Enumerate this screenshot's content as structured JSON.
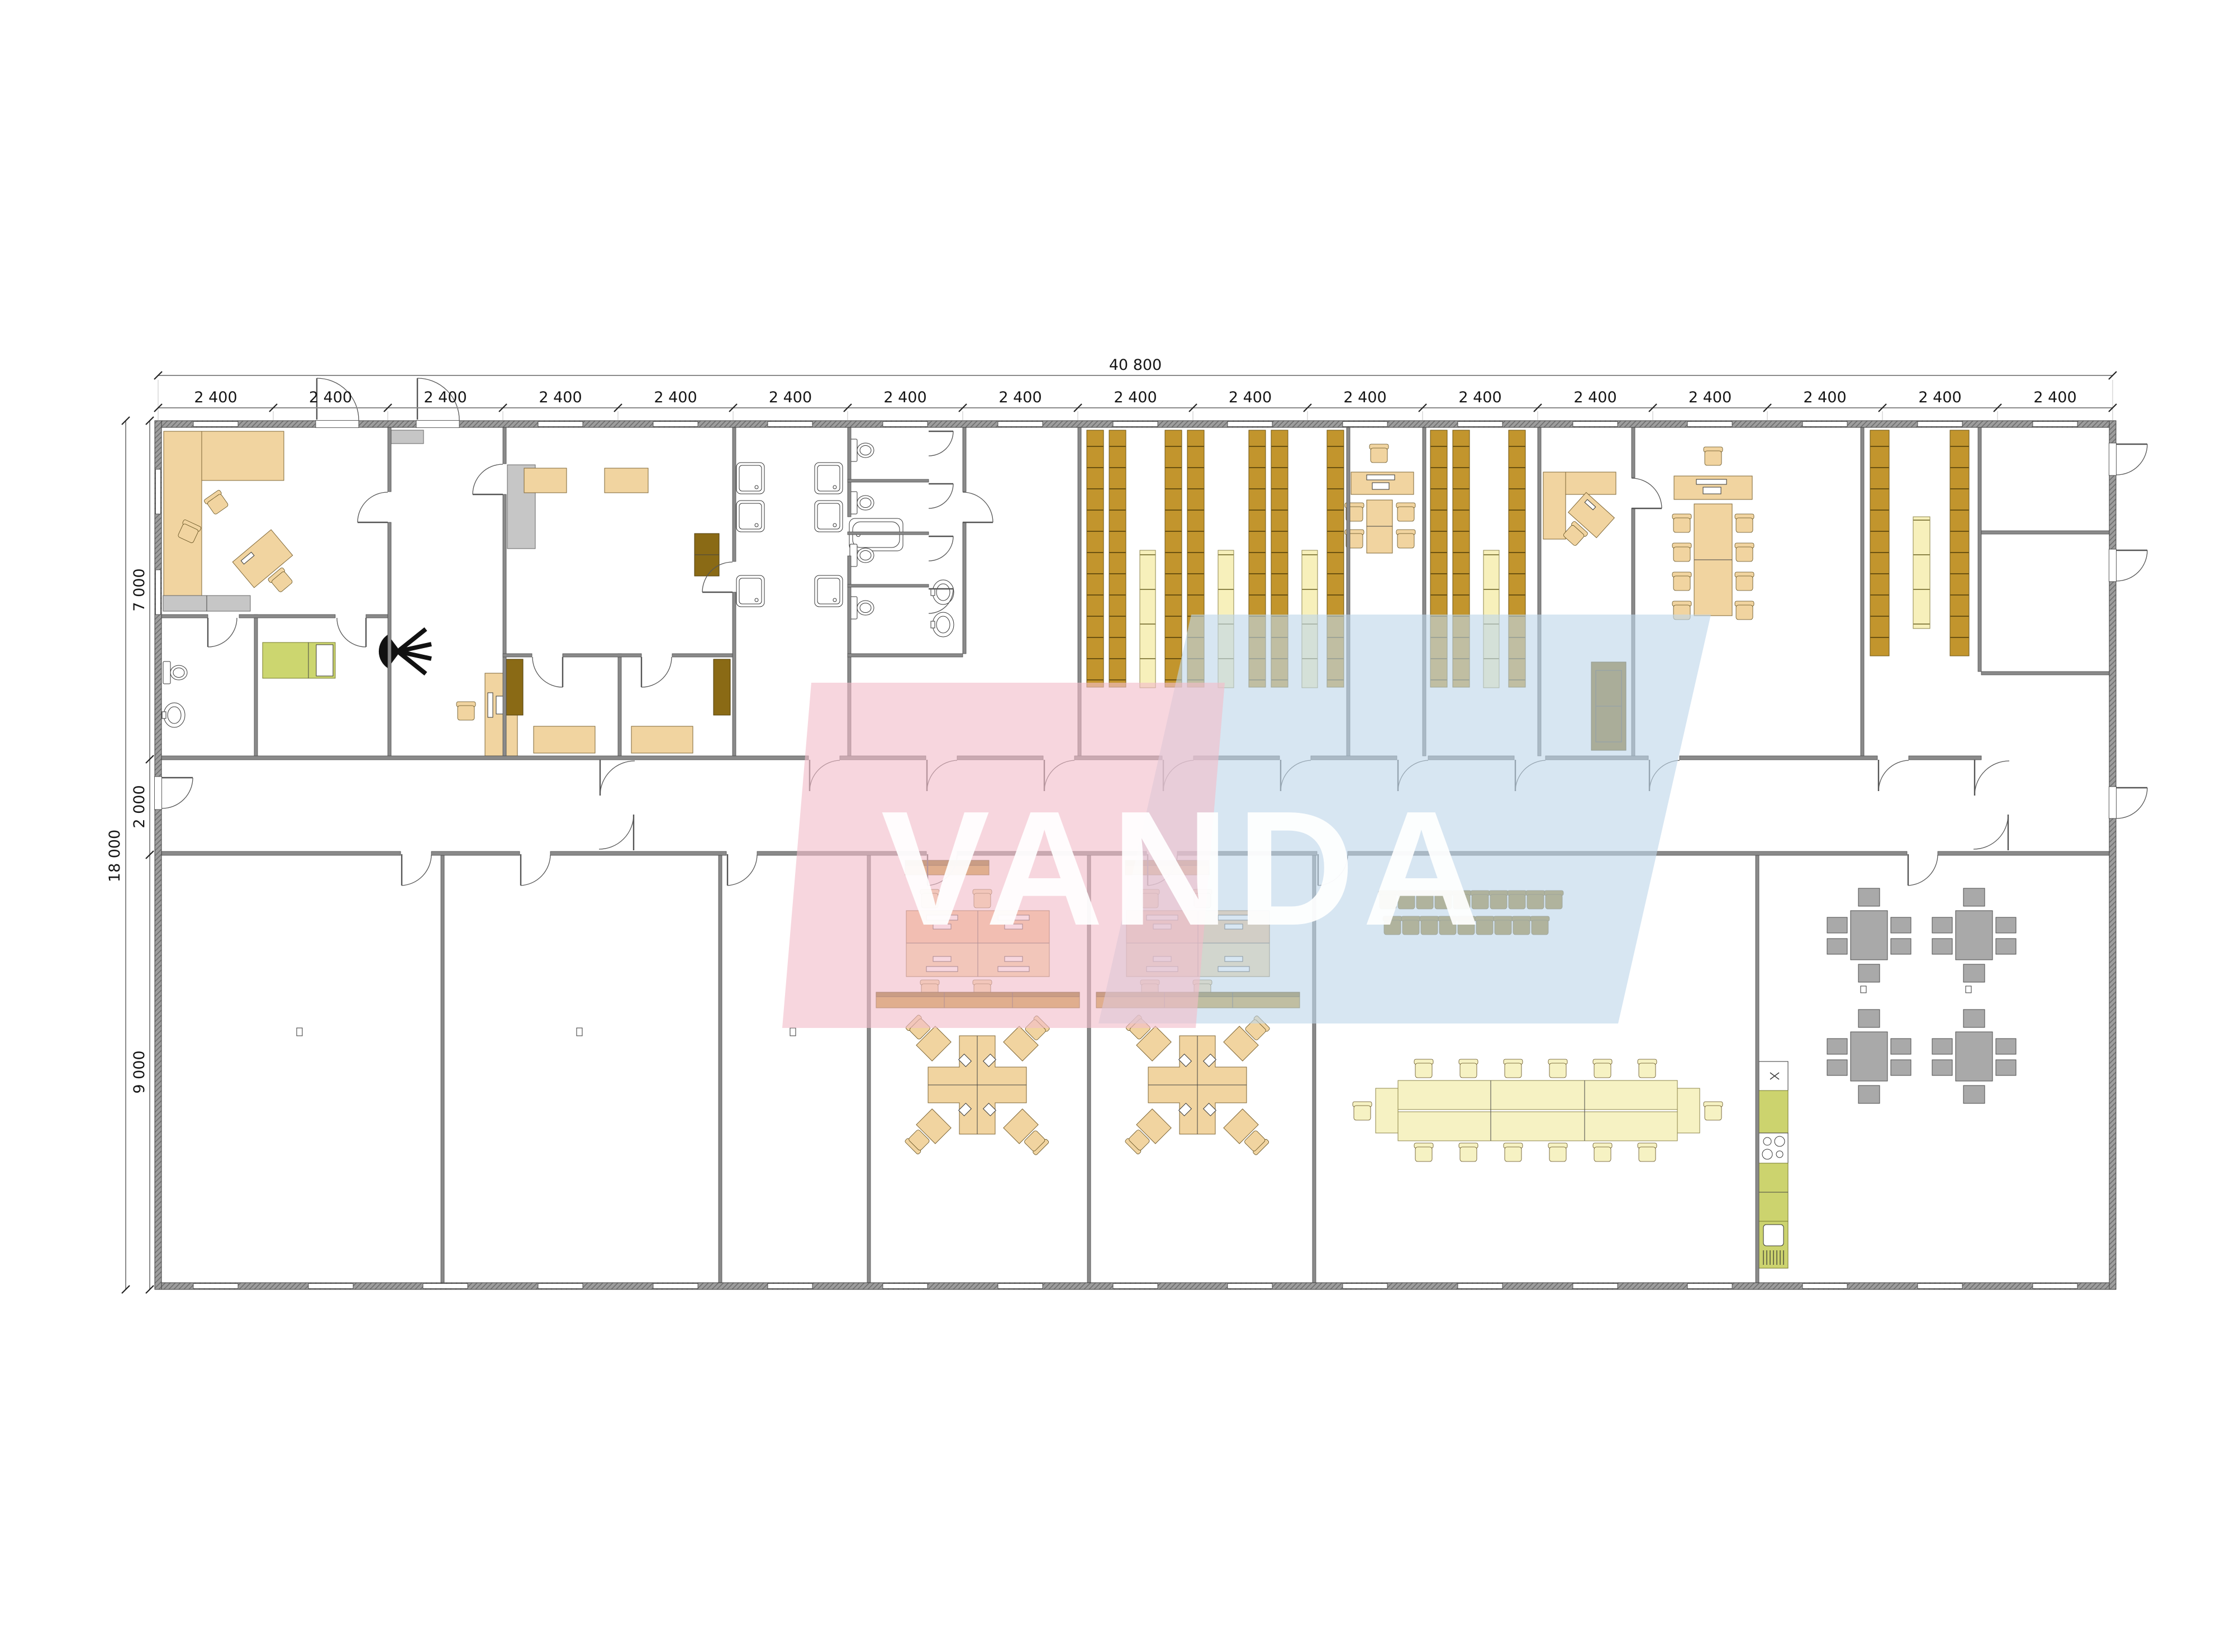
{
  "watermark": {
    "text": "VANDA"
  },
  "dimensions": {
    "total_width_label": "40 800",
    "top_segments": [
      "2 400",
      "2 400",
      "2 400",
      "2 400",
      "2 400",
      "2 400",
      "2 400",
      "2 400",
      "2 400",
      "2 400",
      "2 400",
      "2 400",
      "2 400",
      "2 400",
      "2 400",
      "2 400",
      "2 400"
    ],
    "left_total_label": "18 000",
    "left_segments": [
      "7 000",
      "2 000",
      "9 000"
    ]
  },
  "colors": {
    "tan": "#f1d4a0",
    "orange": "#f2bf8d",
    "mustard": "#c2952d",
    "dark": "#8a6a15",
    "pale": "#f7f0bb",
    "paletable": "#f6f2c3",
    "bed": "#ccd66f",
    "kitchen": "#ccd36e",
    "graytable": "#a9a9a9",
    "trainbrown": "#9a7a21",
    "wall": "#8a8a8a",
    "lgray": "#c6c6c6",
    "pink": "#f2bdca",
    "blue": "#bfd7ea",
    "dim": "#151515"
  }
}
